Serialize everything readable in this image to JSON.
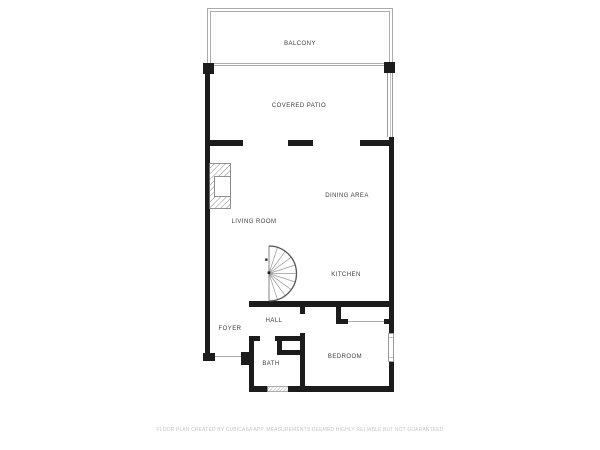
{
  "floor_plan": {
    "rooms": {
      "balcony": "BALCONY",
      "covered_patio": "COVERED PATIO",
      "dining_area": "DINING AREA",
      "living_room": "LIVING ROOM",
      "kitchen": "KITCHEN",
      "hall": "HALL",
      "foyer": "FOYER",
      "bath": "BATH",
      "bedroom": "BEDROOM"
    },
    "disclaimer": "FLOOR PLAN CREATED BY CUBICASA APP. MEASUREMENTS DEEMED HIGHLY RELIABLE BUT NOT GUARANTEED",
    "icons": {
      "spiral_staircase": "semicircular-fan-of-treads",
      "fireplace": "hatched-masonry-with-firebox",
      "window": "double-line-slot",
      "entry_opening": "thin-threshold-line"
    },
    "colors": {
      "wall": "#1c1c1c",
      "thin_line": "#ababab",
      "label_text": "#3d3d3d",
      "disclaimer_text": "#c6c6c6",
      "background": "#ffffff"
    }
  }
}
